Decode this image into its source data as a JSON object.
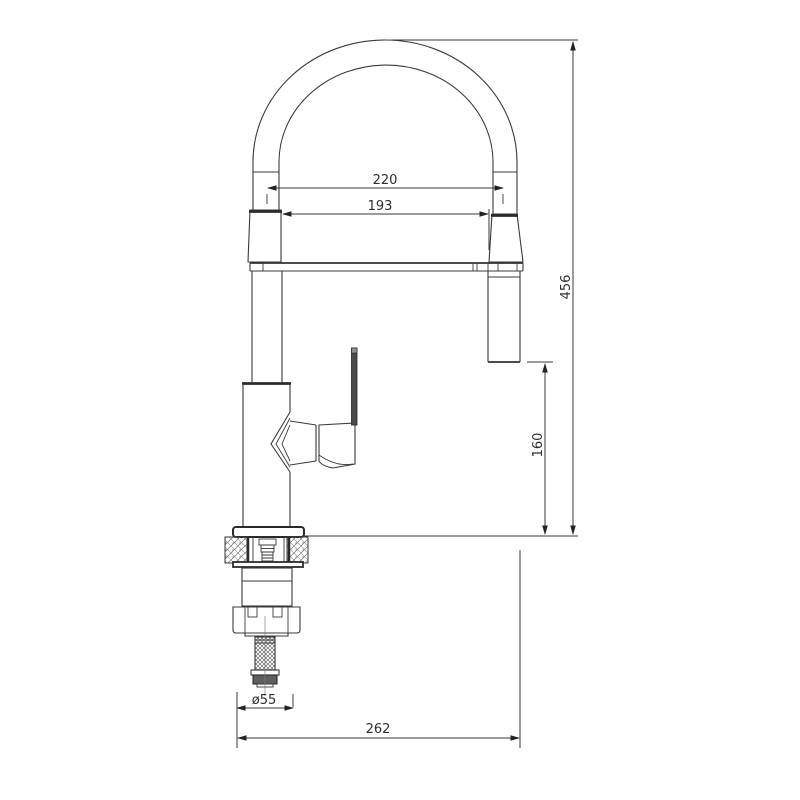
{
  "drawing": {
    "subject": "kitchen pull-down spray faucet dimensioned technical drawing",
    "background_color": "#ffffff",
    "line_color": "#3a3a3a",
    "handle_fill_color": "#4a4a4a",
    "handle_cap_color": "#909090",
    "dimensions": {
      "hose_span_width": "220",
      "spout_inner_width": "193",
      "overall_height": "456",
      "spray_outlet_height_above_counter": "160",
      "base_diameter": "ø55",
      "overall_reach": "262"
    }
  }
}
